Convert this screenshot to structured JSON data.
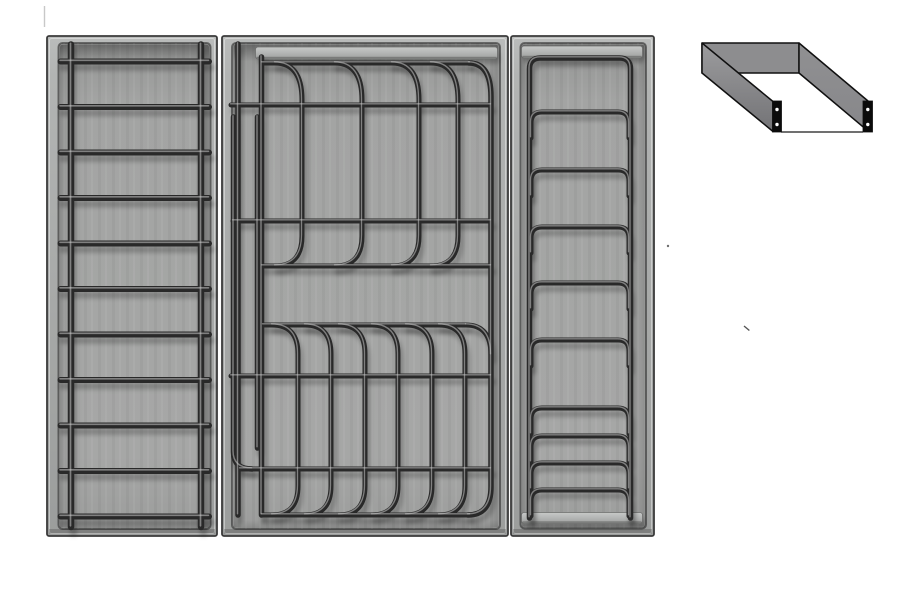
{
  "meta": {
    "description": "Grey 3D render of three drawer organiser trays (bar ladder tray, plate rack tray with curved prongs, arched plate holder tray) and an isometric U-channel mounting bracket diagram",
    "background": "#ffffff"
  },
  "palette": {
    "face_top": "#babcbb",
    "face_mid": "#a8aaa9",
    "face_bottom": "#9b9d9c",
    "floor_top": "#949594",
    "floor_mid": "#a3a4a3",
    "floor_bottom": "#9c9d9c",
    "tray_outline": "#3a3a3a",
    "recess_line": "rgba(35,35,35,0.55)",
    "wire_dark": "#292929",
    "wire_highlight": "rgba(200,200,200,0.55)",
    "wire_shadow": "rgba(0,0,0,0.22)",
    "bar_light_top": "#c7c9c8",
    "bar_light_mid": "#b5b7b6",
    "bar_light_bottom": "#9e9f9e",
    "bracket_back": "#8d8d8f",
    "bracket_left_light": "#9c9c9e",
    "bracket_left_dark": "#737376",
    "bracket_right": "#87878a",
    "bracket_outline": "#101010",
    "plate_black": "#0b0b0b",
    "hole_white": "#ffffff"
  },
  "trays": [
    {
      "name": "bar-ladder-tray",
      "x": 47,
      "y": 36,
      "w": 170,
      "h": 500,
      "recess": {
        "l": 11.5,
        "t": 7,
        "r": 6.5,
        "b": 7
      },
      "rails": {
        "xs": [
          71,
          201
        ],
        "w": 6.5,
        "y1": 44.5,
        "y2": 527
      },
      "bars": {
        "count": 11,
        "y_first": 61.5,
        "spacing": 45.5,
        "x1": 60.5,
        "x2": 209,
        "w": 6
      }
    },
    {
      "name": "plate-rack-tray",
      "x": 222,
      "y": 36,
      "w": 286,
      "h": 500,
      "recess": {
        "l": 10,
        "t": 7,
        "r": 8,
        "b": 7
      },
      "top_bar": {
        "x": 255.5,
        "y": 47,
        "w": 242,
        "h": 12
      },
      "left_rails": [
        {
          "x": 238,
          "y1": 44,
          "y2": 515
        },
        {
          "x": 261.5,
          "y1": 57,
          "y2": 515
        },
        {
          "x": 233.5,
          "y1": 117,
          "y2": 452,
          "elbow_to": [
            252,
            469
          ]
        },
        {
          "x": 257.5,
          "y1": 117,
          "y2": 448
        }
      ],
      "h_wires": [
        {
          "y": 63,
          "x1": 262,
          "x2": 470
        },
        {
          "y": 105,
          "x1": 231,
          "x2": 491
        },
        {
          "y": 221,
          "x1": 233,
          "x2": 491
        },
        {
          "y": 266,
          "x1": 262,
          "x2": 491
        },
        {
          "y": 325,
          "x1": 263,
          "x2": 466
        },
        {
          "y": 376,
          "x1": 231,
          "x2": 491
        },
        {
          "y": 469,
          "x1": 240,
          "x2": 491
        },
        {
          "y": 515,
          "x1": 262,
          "x2": 470
        }
      ],
      "upper_prongs": {
        "hook_xs": [
          275,
          335,
          392,
          431
        ],
        "dx": 27,
        "y_top": 63,
        "y_v1": 100,
        "y_v2": 236,
        "y_bottom": 266
      },
      "lower_prongs": {
        "hook_xs": [
          272,
          305,
          339,
          372,
          406,
          439
        ],
        "dx": 26,
        "y_top": 325,
        "y_v1": 354,
        "y_v2": 486,
        "y_bottom": 515
      },
      "right_frame": {
        "hook_x": 469,
        "x": 491,
        "y_top": 63,
        "y_bottom": 515,
        "hook2_x": 466,
        "hook2_y": 325
      }
    },
    {
      "name": "arch-rack-tray",
      "x": 511,
      "y": 36,
      "w": 143,
      "h": 500,
      "recess": {
        "l": 9.5,
        "t": 7,
        "r": 8,
        "b": 7.5
      },
      "top_bar": {
        "x": 521.5,
        "y": 46,
        "w": 121,
        "h": 12
      },
      "bottom_bar": {
        "x": 521.5,
        "y": 512.5,
        "w": 121,
        "h": 11
      },
      "frame": {
        "x1": 529.5,
        "x2": 630.5,
        "y_top": 58,
        "r": 11,
        "y_bottom": 518
      },
      "arches": {
        "x1": 531,
        "x2": 629,
        "r": 11,
        "tail": 26,
        "tops": [
          112,
          170,
          227,
          283,
          340,
          408,
          436,
          463,
          490
        ]
      }
    }
  ],
  "bracket": {
    "back_wall": [
      [
        702,
        43
      ],
      [
        799,
        43
      ],
      [
        799,
        73
      ],
      [
        702,
        73
      ]
    ],
    "left_wall": [
      [
        702,
        43
      ],
      [
        773,
        101.5
      ],
      [
        773,
        131.5
      ],
      [
        702,
        73
      ]
    ],
    "right_wall": [
      [
        799,
        43
      ],
      [
        868,
        101
      ],
      [
        868,
        131
      ],
      [
        799,
        73
      ]
    ],
    "bottom_line": [
      [
        781,
        132
      ],
      [
        863,
        132
      ]
    ],
    "plates": [
      {
        "x": 772.5,
        "y": 101,
        "w": 9,
        "h": 31,
        "cx": 777,
        "holes_y": [
          109.5,
          124.5
        ]
      },
      {
        "x": 863,
        "y": 101,
        "w": 9.5,
        "h": 31,
        "cx": 867.8,
        "holes_y": [
          109.5,
          124.5
        ]
      }
    ],
    "hole_r": 1.7
  },
  "specks": [
    {
      "type": "dot",
      "x": 668,
      "y": 246,
      "size": 2.4,
      "color": "#6f6f6f"
    },
    {
      "type": "dash",
      "x": 744,
      "y": 326,
      "len": 7,
      "angle": 40,
      "color": "#555555"
    },
    {
      "type": "vline",
      "x": 44.5,
      "y": 6,
      "len": 21,
      "angle": 90,
      "color": "#c8c8c8"
    }
  ]
}
